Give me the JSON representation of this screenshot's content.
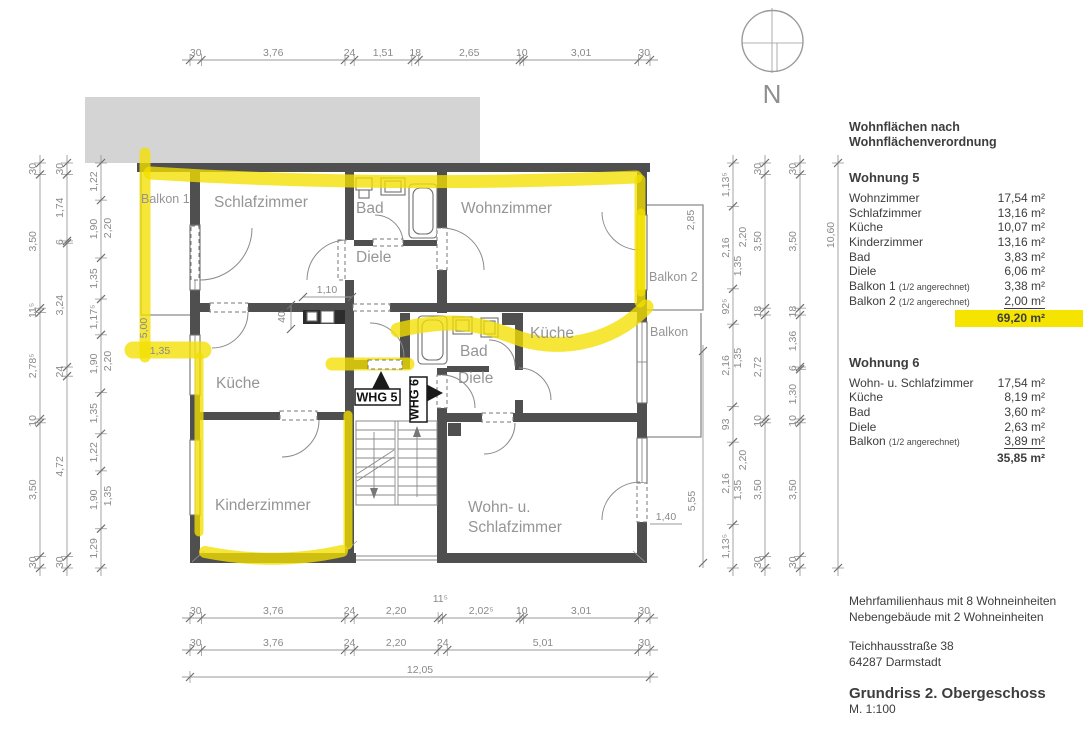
{
  "area_table": {
    "heading_line1": "Wohnflächen nach",
    "heading_line2": "Wohnflächenverordnung",
    "wohnung5": {
      "title": "Wohnung 5",
      "rows": [
        {
          "label": "Wohnzimmer",
          "note": "",
          "value": "17,54 m²"
        },
        {
          "label": "Schlafzimmer",
          "note": "",
          "value": "13,16 m²"
        },
        {
          "label": "Küche",
          "note": "",
          "value": "10,07 m²"
        },
        {
          "label": "Kinderzimmer",
          "note": "",
          "value": "13,16 m²"
        },
        {
          "label": "Bad",
          "note": "",
          "value": "3,83 m²"
        },
        {
          "label": "Diele",
          "note": "",
          "value": "6,06 m²"
        },
        {
          "label": "Balkon 1",
          "note": "(1/2 angerechnet)",
          "value": "3,38 m²"
        },
        {
          "label": "Balkon 2",
          "note": "(1/2 angerechnet)",
          "value": "2,00 m²"
        }
      ],
      "total": "69,20 m²"
    },
    "wohnung6": {
      "title": "Wohnung 6",
      "rows": [
        {
          "label": "Wohn- u. Schlafzimmer",
          "note": "",
          "value": "17,54 m²"
        },
        {
          "label": "Küche",
          "note": "",
          "value": "8,19 m²"
        },
        {
          "label": "Bad",
          "note": "",
          "value": "3,60 m²"
        },
        {
          "label": "Diele",
          "note": "",
          "value": "2,63 m²"
        },
        {
          "label": "Balkon",
          "note": "(1/2 angerechnet)",
          "value": "3,89 m²"
        }
      ],
      "total": "35,85 m²"
    }
  },
  "project": {
    "line1": "Mehrfamilienhaus mit 8 Wohneinheiten",
    "line2": "Nebengebäude mit 2 Wohneinheiten",
    "street": "Teichhausstraße 38",
    "city": "64287 Darmstadt",
    "drawing_title": "Grundriss 2. Obergeschoss",
    "scale": "M. 1:100"
  },
  "compass": {
    "north_label": "N"
  },
  "rooms": {
    "balkon1": "Balkon 1",
    "schlafzimmer": "Schlafzimmer",
    "bad5": "Bad",
    "wohnzimmer": "Wohnzimmer",
    "diele5": "Diele",
    "kueche5": "Küche",
    "balkon2": "Balkon 2",
    "balkon": "Balkon",
    "kueche6": "Küche",
    "bad6": "Bad",
    "diele6": "Diele",
    "kinderzimmer": "Kinderzimmer",
    "wohnschlaf_line1": "Wohn- u.",
    "wohnschlaf_line2": "Schlafzimmer"
  },
  "unit_tags": {
    "whg5": "WHG 5",
    "whg6": "WHG 6"
  },
  "colors": {
    "highlight": "#f2df00",
    "wall": "#4f4f4f",
    "neighbor_block": "#d4d4d4"
  },
  "dims": {
    "top": [
      "30",
      "3,76",
      "24",
      "1,51",
      "18",
      "2,65",
      "10",
      "3,01",
      "30"
    ],
    "bottom1": [
      "30",
      "3,76",
      "24",
      "2,20",
      "11⁵",
      "2,02⁵",
      "10",
      "3,01",
      "30"
    ],
    "bottom2": [
      "30",
      "3,76",
      "24",
      "2,20",
      "24",
      "5,01",
      "30"
    ],
    "bottom_total": [
      "12,05"
    ],
    "left1": [
      "30",
      "3,50",
      "11⁵",
      "2,78⁵",
      "10",
      "3,50",
      "30"
    ],
    "left2": [
      "30",
      "1,74",
      "6",
      "3,24",
      "24",
      "4,72",
      "30"
    ],
    "left3": [
      "1,22",
      "1,90",
      "1,35",
      "1,17⁵",
      "1,90",
      "1,35",
      "1,22",
      "1,90",
      "1,29"
    ],
    "left3_extra": [
      "2,20",
      "2,20",
      "1,35"
    ],
    "right1": [
      "1,13⁵",
      "2,16",
      "92⁵",
      "2,16",
      "93",
      "2,16",
      "1,13⁵"
    ],
    "right1_extra": [
      "2,20",
      "1,35",
      "1,35",
      "2,20",
      "1,35"
    ],
    "right2": [
      "30",
      "3,50",
      "18",
      "2,72",
      "10",
      "3,50",
      "30"
    ],
    "right3": [
      "30",
      "3,50",
      "18",
      "1,36",
      "6",
      "1,30",
      "10",
      "3,50",
      "30"
    ],
    "right_total": [
      "10,60"
    ],
    "interior": {
      "counter_len": "1,10",
      "counter_depth": "40",
      "balkon1_len": "5,00",
      "balkon1_w": "1,35",
      "balkon2_h": "2,85",
      "balkon_right_h": "5,55",
      "door_w": "1,40"
    }
  }
}
